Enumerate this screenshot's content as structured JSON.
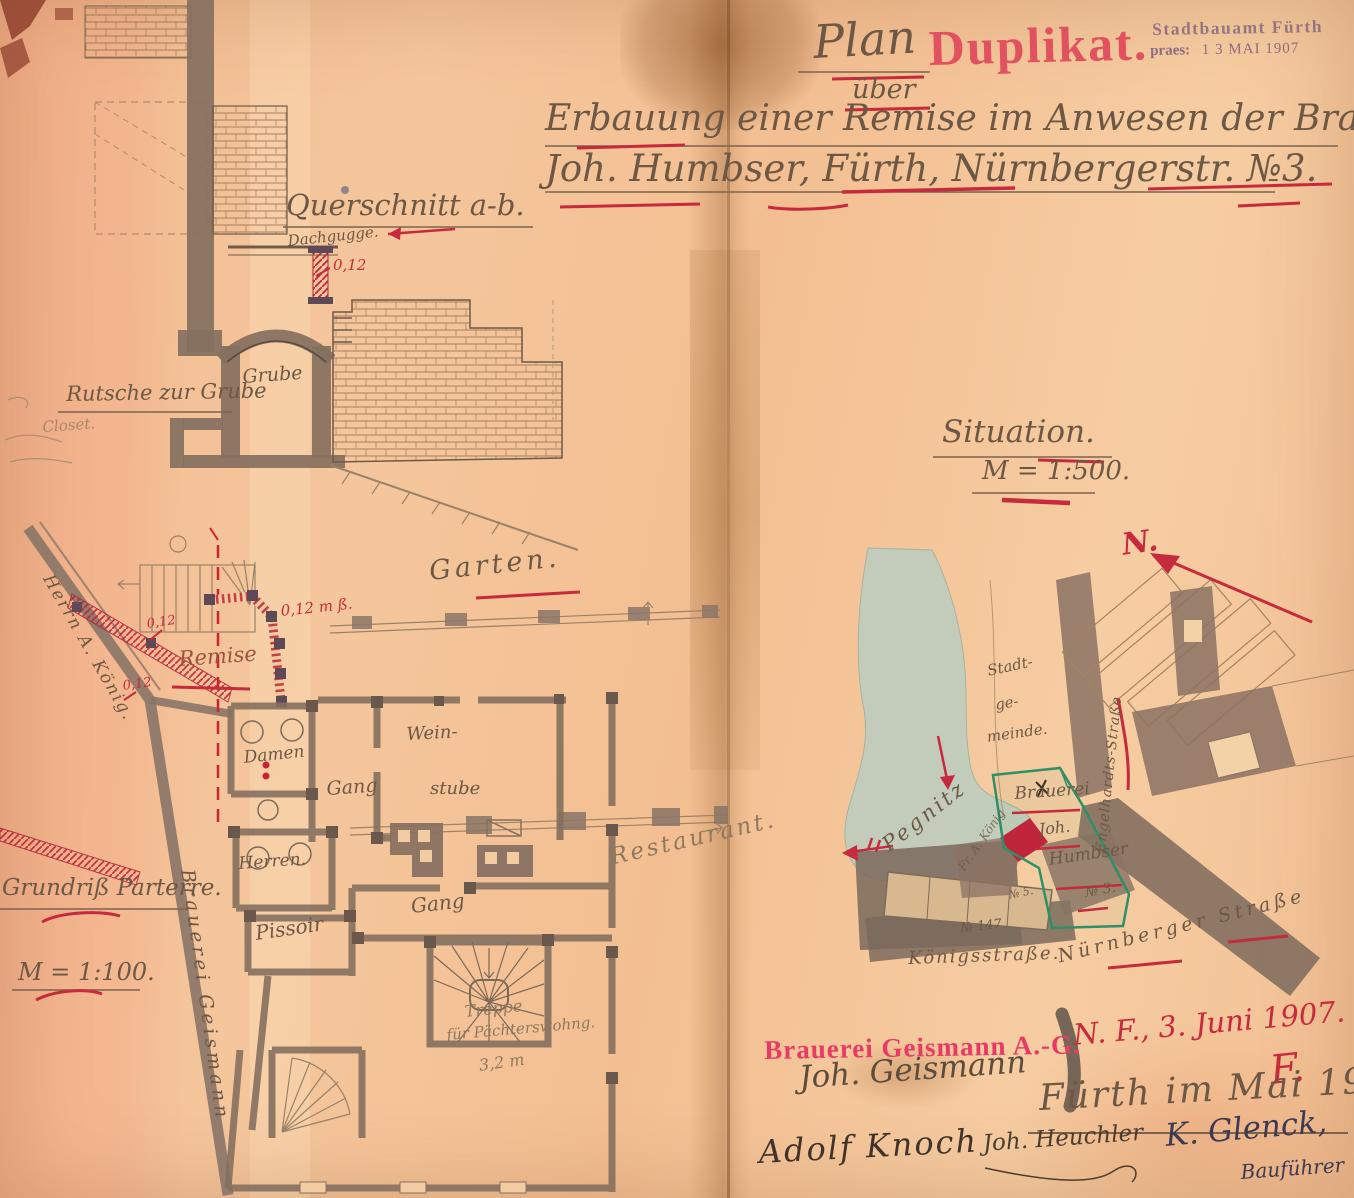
{
  "document": {
    "kind": "Historical building permit plan, Fürth 1907 (scanned duplicate)",
    "colors": {
      "paper": "#f3c094",
      "ink_brown": "#6d5846",
      "ink_red": "#c62a3c",
      "stamp_pink": "#e73b66",
      "stamp_purple": "#8d6d80",
      "wall_wash": "#85705f",
      "river": "#b7cec3",
      "boundary_green": "#2e8f68"
    }
  },
  "header": {
    "plan_word": "Plan",
    "duplikat_stamp": "Duplikat.",
    "office_stamp_line1": "Stadtbauamt Fürth",
    "office_stamp_praes": "praes:",
    "office_stamp_date": "1 3 MAI 1907",
    "ueber_word": "über",
    "title_line1": "Erbauung einer Remise im Anwesen der Brauerei",
    "title_line2": "Joh. Humbser, Fürth, Nürnbergerstr. №3."
  },
  "cross_section": {
    "title": "Querschnitt a-b.",
    "dachgugge_label": "Dachgugge.",
    "dim_012": "0,12",
    "grube_label": "Grube",
    "rutsche_label": "Rutsche zur Grube",
    "margin_note": "Closet."
  },
  "situation": {
    "title": "Situation.",
    "scale": "M = 1:500.",
    "north_label": "N.",
    "pegnitz_label": "Pegnitz",
    "stadtgemeinde_l1": "Stadt-",
    "stadtgemeinde_l2": "ge-",
    "stadtgemeinde_l3": "meinde.",
    "engelhardts_label": "Engelhardts-Straße",
    "brauerei_label": "Brauerei",
    "joh_label": "Joh.",
    "humbser_label": "Humbser",
    "no3_label": "№ 3.",
    "no5_label": "№ 5.",
    "no147_label": "№ 147",
    "koenig_parcel_label": "Fr. A. König",
    "koenigsstrasse_label": "Königsstraße.",
    "nuernberger_label": "Nürnberger Straße"
  },
  "floor_plan": {
    "garten_label": "Garten.",
    "remise_label": "Remise",
    "dim_a": "0,12",
    "dim_b": "0,12 m ß.",
    "dim_c": "0,12",
    "wein_l1": "Wein-",
    "wein_l2": "stube",
    "gang1_label": "Gang",
    "gang2_label": "Gang",
    "damen_label": "Damen",
    "herren_label": "Herren.",
    "pissoir_label": "Pissoir",
    "treppe_l1": "Treppe",
    "treppe_l2": "für Pächterswohng.",
    "treppe_dim": "3,2 m",
    "restaurant_label": "Restaurant.",
    "grundriss_title": "Grundriß Parterre.",
    "scale": "M = 1:100.",
    "brauerei_vertical": "Brauerei Geismann",
    "neighbor_label": "Herrn A. König."
  },
  "footer": {
    "geismann_stamp": "Brauerei Geismann A.-G.",
    "geismann_signature": "Joh. Geismann",
    "red_date": "N. F., 3. Juni 1907.",
    "red_monogram": "F.",
    "fuerth_date": "Fürth im Mai 1907.",
    "signature_left": "Adolf Knoch",
    "signature_middle": "Joh. Heuchler",
    "signature_right": "K. Glenck,",
    "signature_right_role": "Bauführer"
  }
}
